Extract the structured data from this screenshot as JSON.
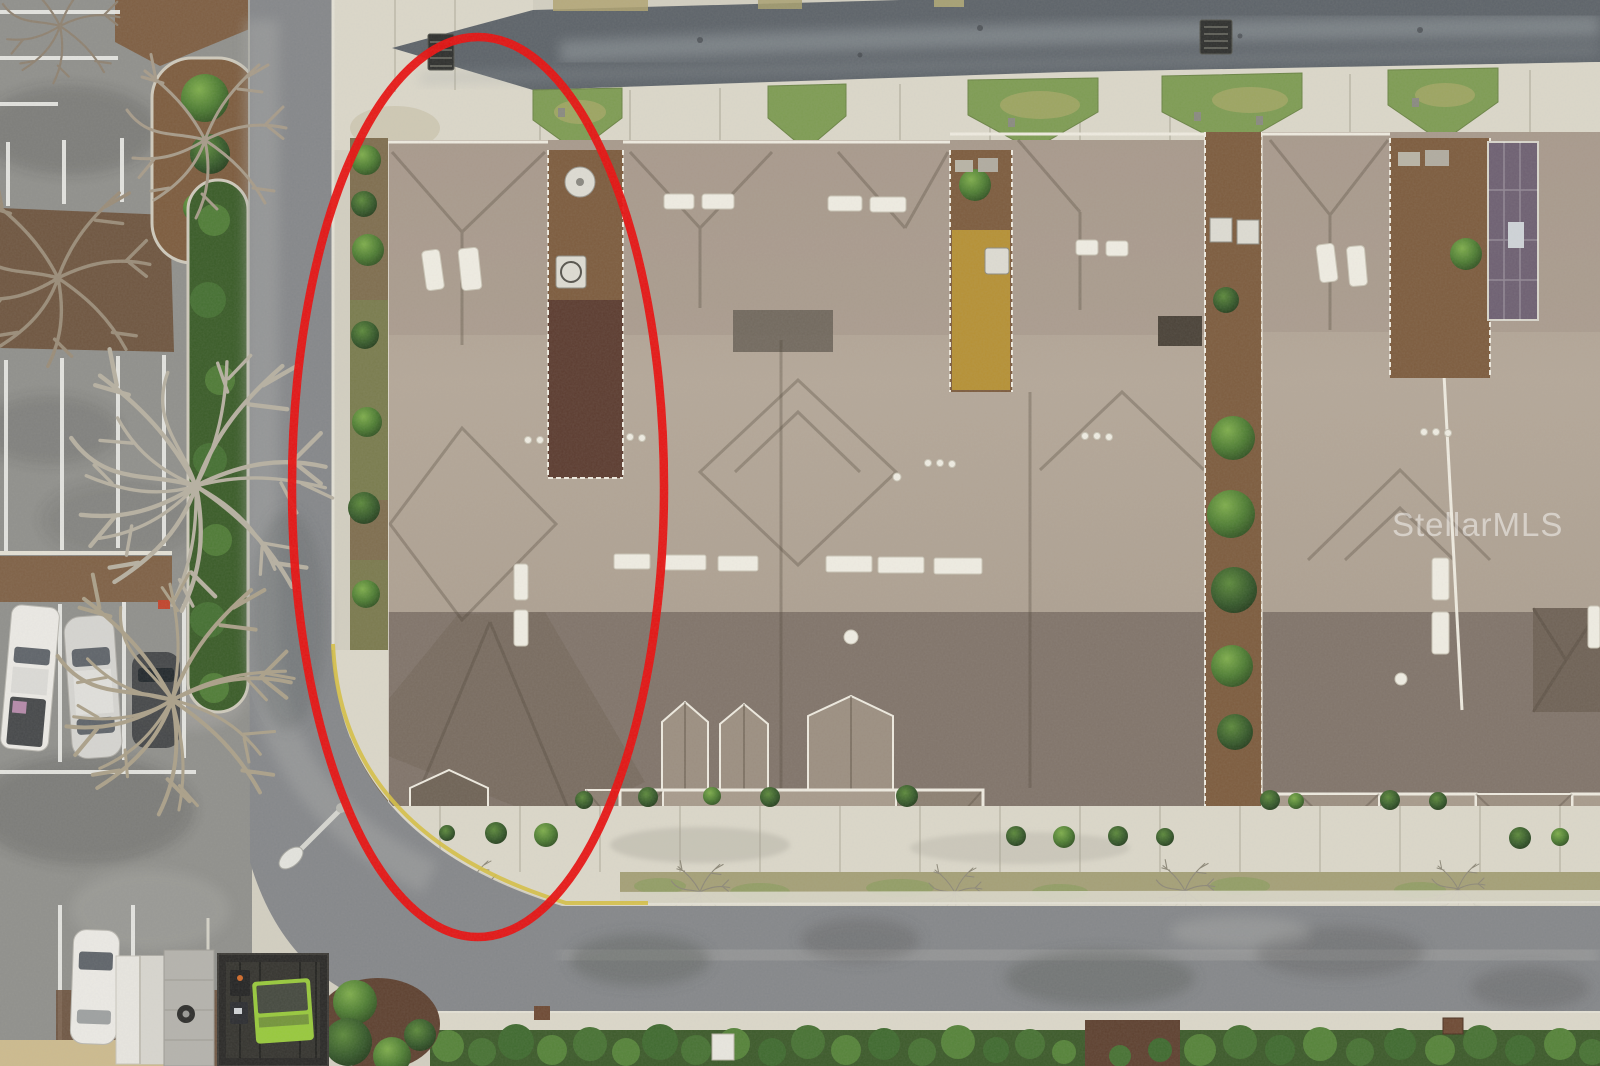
{
  "scene": {
    "watermark": "StellarMLS",
    "annotation": {
      "shape": "ellipse",
      "purpose": "highlighted-subject-unit",
      "color": "#e8100f"
    }
  },
  "colors": {
    "pavementBase": "#d3cfc1",
    "concreteBright": "#dcd8ca",
    "concreteJoint": "#b7b2a2",
    "lotAsphalt": "#90908c",
    "roadTop": "#5d6369",
    "roadWorn": "#9aa0a4",
    "street": "#85878a",
    "streetWorn": "#a8a9a7",
    "curbWhite": "#e4e1d5",
    "yellowCurb": "#d6c044",
    "stallLine": "#ebebe6",
    "roofBack": "#a89a8c",
    "roofMain": "#b5a899",
    "roofFront": "#81746a",
    "roofGable": "#9c8f81",
    "gutter": "#efebe0",
    "ventWhite": "#f0ede3",
    "grass": "#7e9c53",
    "grassDry": "#a5a077",
    "mulch": "#7d5c3e",
    "mulchDark": "#5e4130",
    "hedgeDark": "#3c5a2a",
    "hedgeLight": "#558339",
    "bushMid": "#4e7d33",
    "treeGray": "#a79b89",
    "treePale": "#b7b0a1",
    "red": "#e8100f",
    "carWhite": "#eceae5",
    "carSilver": "#d6d5d1",
    "carDark": "#3f4143",
    "glass": "#5f646a",
    "shedWhite": "#e8e6e0",
    "shedGray": "#b5b3ad",
    "dumpGreen": "#98c93c",
    "enclosure": "#2a2927",
    "purple": "#6e6072",
    "gravel": "#cfc9b4",
    "acWhite": "#dedcd3",
    "drainDark": "#2e2f2d",
    "rust": "#6e4a34",
    "foliageGold": "#c09a34",
    "watermark": "rgba(255,255,255,0.48)"
  }
}
